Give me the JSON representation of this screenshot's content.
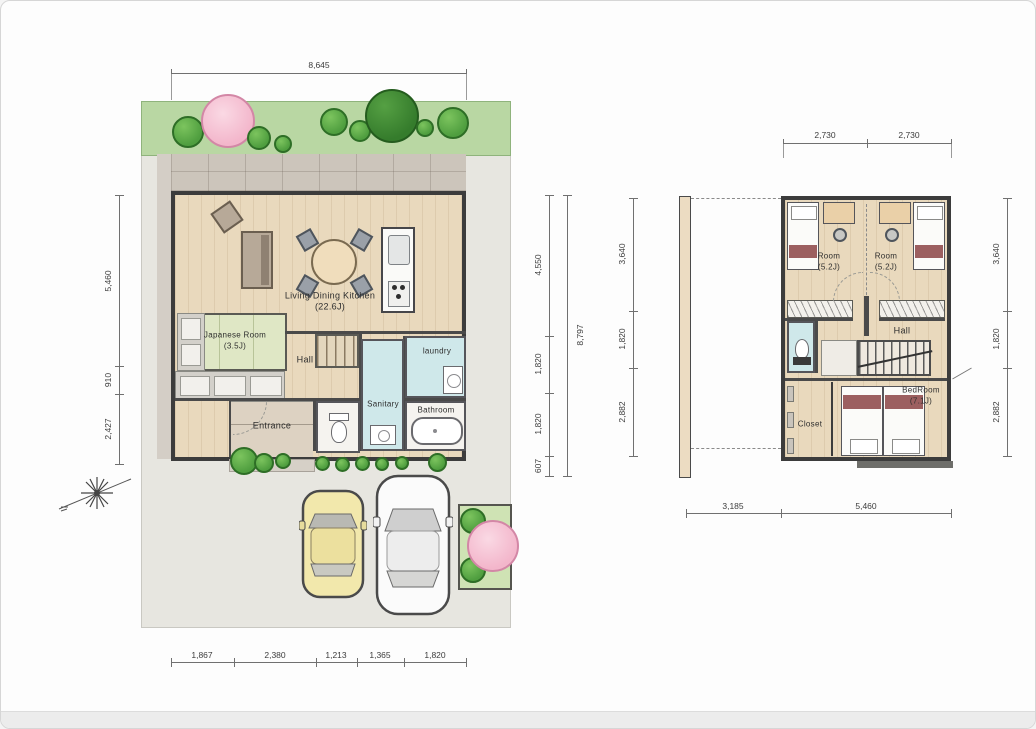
{
  "drawing": {
    "type": "residential floor plans, site plan with 1F (left) and 2F (right)",
    "floor1": {
      "dim_top": "8,645",
      "dims_left": [
        "5,460",
        "910",
        "2,427"
      ],
      "dims_right_inner": [
        "4,550",
        "1,820",
        "1,820",
        "607"
      ],
      "dim_right_outer": "8,797",
      "dims_bottom": [
        "1,867",
        "2,380",
        "1,213",
        "1,365",
        "1,820"
      ],
      "rooms": {
        "ldk": "Living Dining Kitchen",
        "ldk_size": "(22.6J)",
        "japanese": "Japanese Room",
        "japanese_size": "(3.5J)",
        "hall": "Hall",
        "entrance": "Entrance",
        "sanitary": "Sanitary",
        "laundry": "laundry",
        "bathroom": "Bathroom"
      }
    },
    "floor2": {
      "dims_top": [
        "2,730",
        "2,730"
      ],
      "dims_left": [
        "3,640",
        "1,820",
        "2,882"
      ],
      "dims_right": [
        "3,640",
        "1,820",
        "2,882"
      ],
      "dims_bottom": [
        "3,185",
        "5,460"
      ],
      "rooms": {
        "room1": "Room",
        "room1_size": "(5.2J)",
        "room2": "Room",
        "room2_size": "(5.2J)",
        "hall": "Hall",
        "bedroom": "BedRoom",
        "bedroom_size": "(7.1J)",
        "closet": "Closet"
      }
    },
    "icons": {
      "compass": "north-compass-icon",
      "trees": "tree-icon",
      "cars": [
        "yellow-car",
        "white-car"
      ]
    },
    "colors": {
      "wall": "#3c3c3c",
      "wood_floor": "#e9d9bd",
      "tatami": "#dfe7c5",
      "wet_area": "#cfe8ea",
      "greenbelt": "#b9d7a3",
      "tree_green": "#4f9e3f",
      "tree_pink": "#f3b6cb",
      "ground": "#e7e6e0",
      "terrace": "#ccc5bb",
      "car_yellow": "#f2e8ac",
      "bed_accent": "#9c5f60"
    }
  }
}
